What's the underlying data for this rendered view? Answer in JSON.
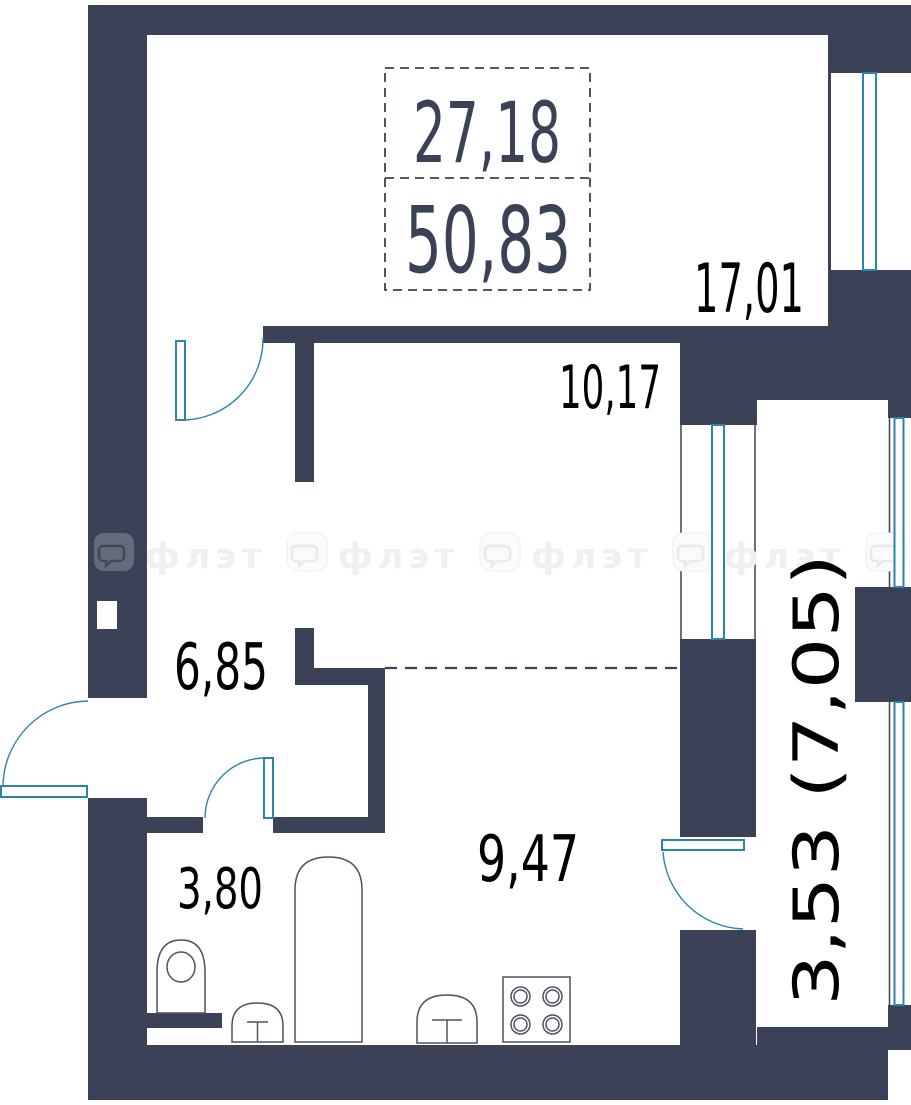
{
  "plan": {
    "living_area": "27,18",
    "total_area": "50,83",
    "rooms": [
      {
        "name": "room-top",
        "area": "17,01"
      },
      {
        "name": "room-middle",
        "area": "10,17"
      },
      {
        "name": "hallway",
        "area": "6,85"
      },
      {
        "name": "bathroom",
        "area": "3,80"
      },
      {
        "name": "kitchen",
        "area": "9,47"
      },
      {
        "name": "balcony",
        "area": "3,53 (7,05)"
      }
    ],
    "watermark_text": "флэт",
    "colors": {
      "wall": "#3b4258",
      "door_window": "#2c85a9",
      "room_label": "#000000",
      "area_summary": "#3b4258",
      "fixture_outline": "#4d5263"
    },
    "fixtures": [
      "toilet",
      "sink",
      "bathtub",
      "kitchen-sink",
      "stove-4-burner"
    ]
  }
}
